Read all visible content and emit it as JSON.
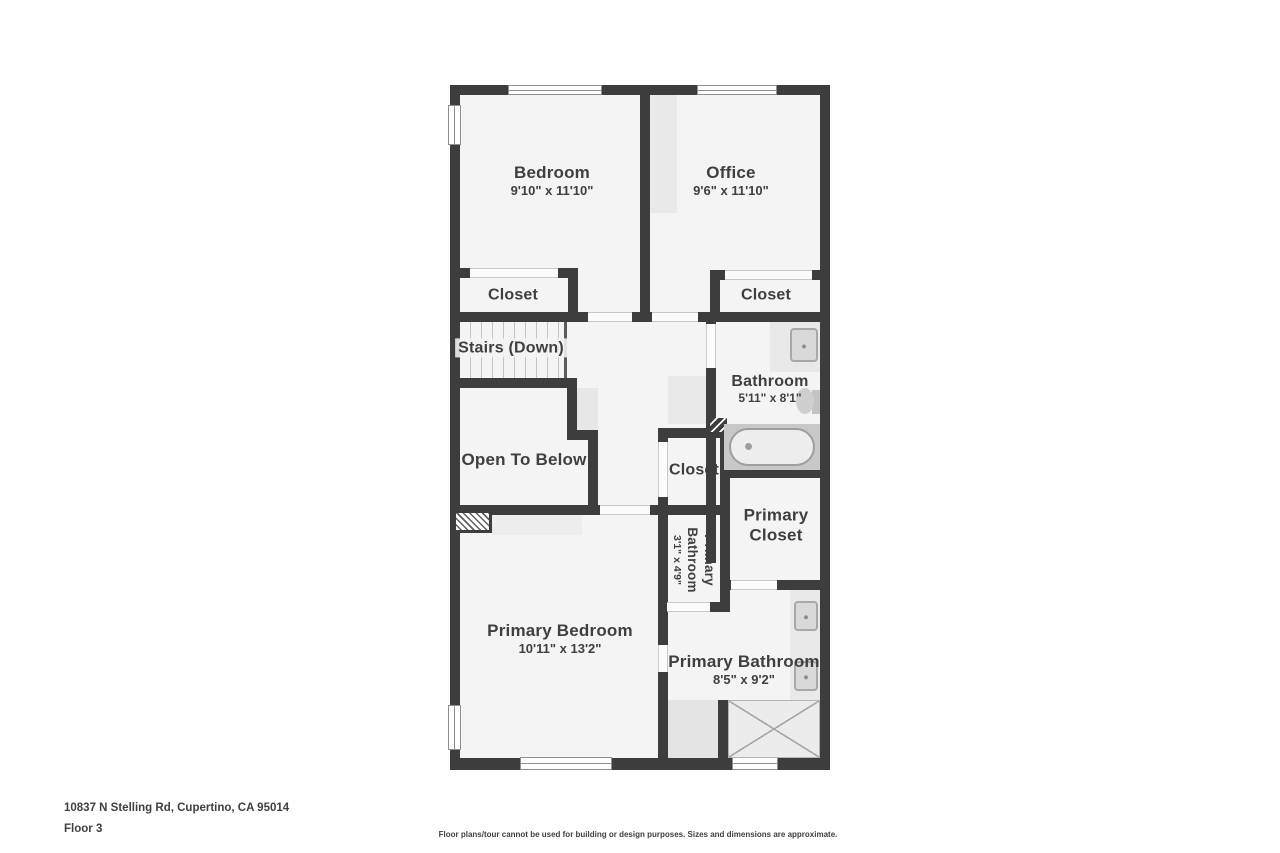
{
  "colors": {
    "wall": "#3d3d3d",
    "floor": "#f4f4f4",
    "fixture": "#e9e9e9",
    "text": "#3f3f3f",
    "page": "#ffffff"
  },
  "rooms": [
    {
      "label": "Bedroom",
      "dims": "9'10\" x 11'10\""
    },
    {
      "label": "Office",
      "dims": "9'6\" x 11'10\""
    },
    {
      "label": "Closet"
    },
    {
      "label": "Closet"
    },
    {
      "label": "Stairs (Down)"
    },
    {
      "label": "Bathroom",
      "dims": "5'11\" x 8'1\""
    },
    {
      "label": "Open To Below"
    },
    {
      "label": "Closet"
    },
    {
      "label": "Primary Closet"
    },
    {
      "label": "Primary Bathroom",
      "dims": "3'1\" x 4'9\""
    },
    {
      "label": "Primary Bedroom",
      "dims": "10'11\" x 13'2\""
    },
    {
      "label": "Primary Bathroom",
      "dims": "8'5\" x 9'2\""
    }
  ],
  "footer": {
    "address": "10837 N Stelling Rd, Cupertino, CA 95014",
    "floor_label": "Floor 3",
    "disclaimer": "Floor plans/tour cannot be used for building or design purposes. Sizes and dimensions are approximate."
  }
}
